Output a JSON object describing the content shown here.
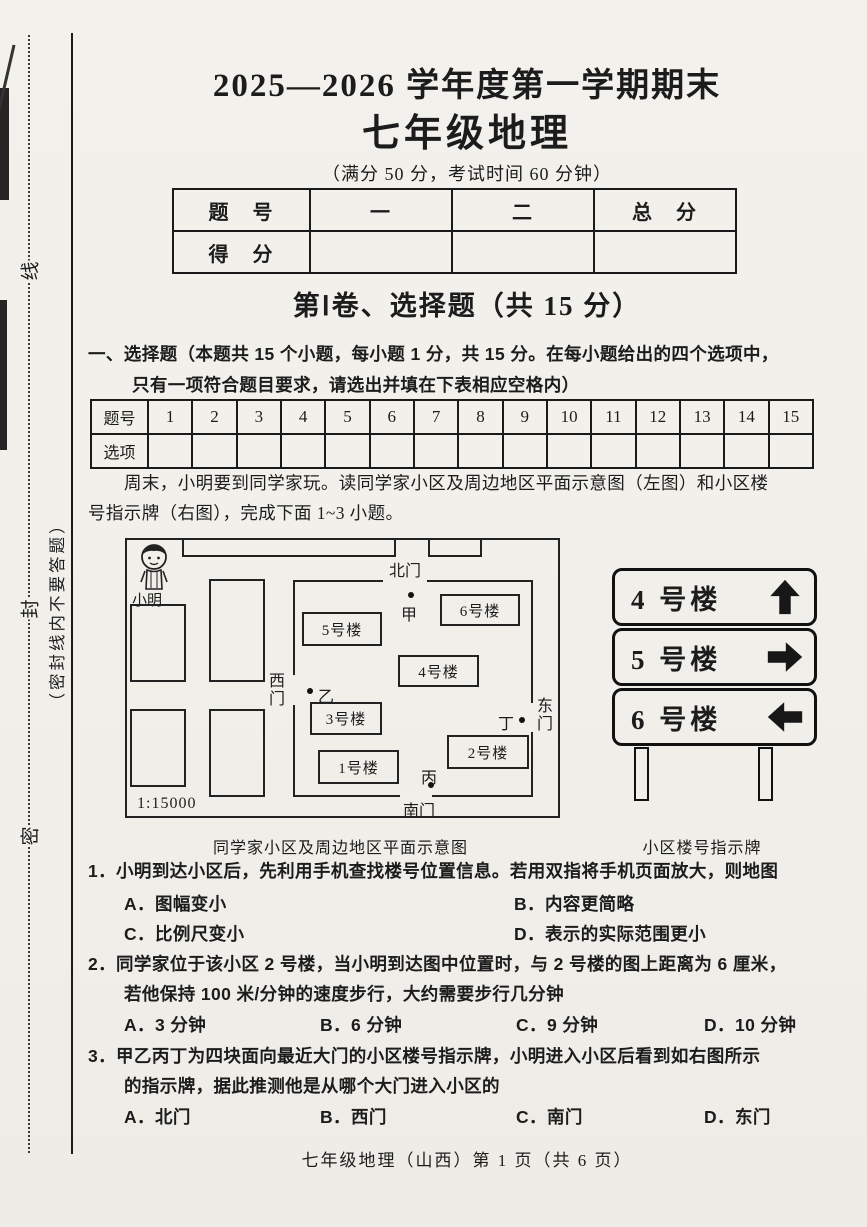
{
  "colors": {
    "paper": "#f1efe9",
    "ink": "#1c1c1c"
  },
  "margin": {
    "seal_chars": [
      "线",
      "封",
      "密"
    ],
    "seal_note": "（密封线内不要答题）"
  },
  "header": {
    "title_line1": "2025—2026 学年度第一学期期末",
    "title_line2": "七年级地理",
    "subtitle": "（满分 50 分，考试时间 60 分钟）"
  },
  "score_table": {
    "headers": [
      "题　号",
      "一",
      "二",
      "总　分"
    ],
    "row_label": "得　分"
  },
  "section1": {
    "heading": "第Ⅰ卷、选择题（共 15 分）",
    "instruction_line1": "一、选择题（本题共 15 个小题，每小题 1 分，共 15 分。在每小题给出的四个选项中，",
    "instruction_line2": "只有一项符合题目要求，请选出并填在下表相应空格内）"
  },
  "answer_table": {
    "row1_label": "题号",
    "row2_label": "选项",
    "numbers": [
      "1",
      "2",
      "3",
      "4",
      "5",
      "6",
      "7",
      "8",
      "9",
      "10",
      "11",
      "12",
      "13",
      "14",
      "15"
    ]
  },
  "passage": {
    "line1": "周末，小明要到同学家玩。读同学家小区及周边地区平面示意图（左图）和小区楼",
    "line2": "号指示牌（右图），完成下面 1~3 小题。"
  },
  "map": {
    "person_label": "小明",
    "gate_north": "北门",
    "gate_south": "南门",
    "gate_west": "西门",
    "gate_east": "东门",
    "point_jia": "甲",
    "point_yi": "乙",
    "point_bing": "丙",
    "point_ding": "丁",
    "buildings": {
      "b1": "1号楼",
      "b2": "2号楼",
      "b3": "3号楼",
      "b4": "4号楼",
      "b5": "5号楼",
      "b6": "6号楼"
    },
    "scale": "1:15000",
    "caption": "同学家小区及周边地区平面示意图"
  },
  "sign": {
    "rows": [
      {
        "label": "4 号楼",
        "arrow": "up"
      },
      {
        "label": "5 号楼",
        "arrow": "right"
      },
      {
        "label": "6 号楼",
        "arrow": "left"
      }
    ],
    "caption": "小区楼号指示牌"
  },
  "questions": {
    "q1": {
      "line1": "1．小明到达小区后，先利用手机查找楼号位置信息。若用双指将手机页面放大，则地图",
      "optA": "A．图幅变小",
      "optB": "B．内容更简略",
      "optC": "C．比例尺变小",
      "optD": "D．表示的实际范围更小"
    },
    "q2": {
      "line1": "2．同学家位于该小区 2 号楼，当小明到达图中位置时，与 2 号楼的图上距离为 6 厘米，",
      "line2": "若他保持 100 米/分钟的速度步行，大约需要步行几分钟",
      "optA": "A．3 分钟",
      "optB": "B．6 分钟",
      "optC": "C．9 分钟",
      "optD": "D．10 分钟"
    },
    "q3": {
      "line1": "3．甲乙丙丁为四块面向最近大门的小区楼号指示牌，小明进入小区后看到如右图所示",
      "line2": "的指示牌，据此推测他是从哪个大门进入小区的",
      "optA": "A．北门",
      "optB": "B．西门",
      "optC": "C．南门",
      "optD": "D．东门"
    }
  },
  "footer": "七年级地理（山西）第 1 页（共 6 页）"
}
